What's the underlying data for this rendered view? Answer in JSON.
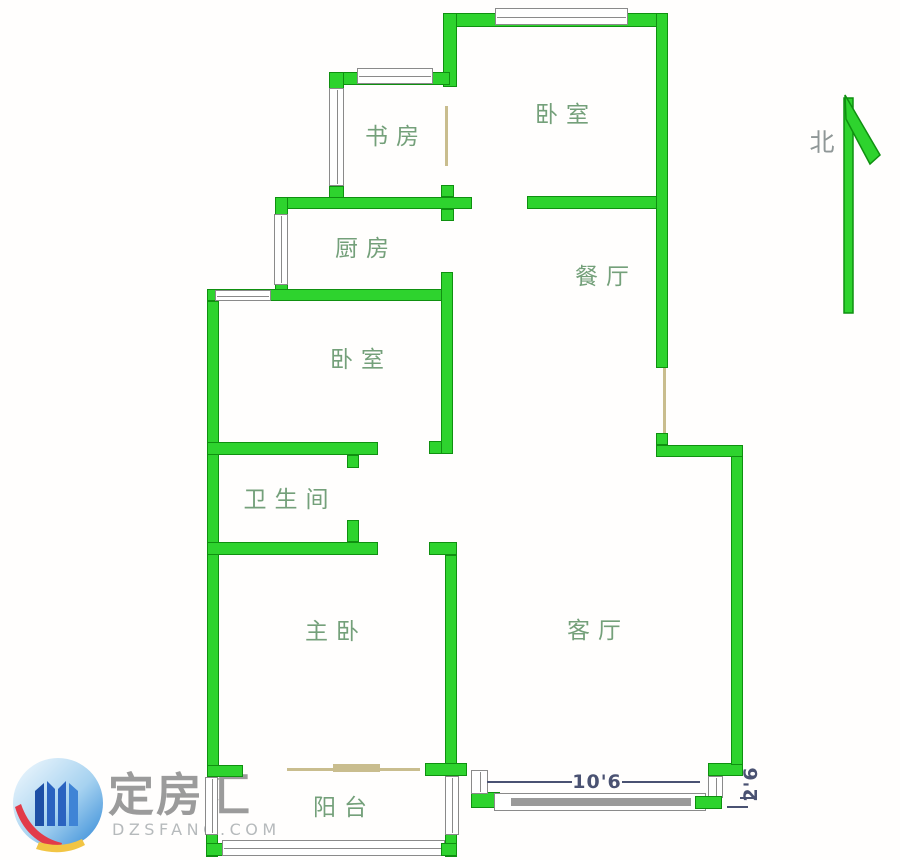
{
  "title": "apartment-floor-plan",
  "colors": {
    "wall_fill": "#2ed32e",
    "wall_border": "#0f9010",
    "window_border": "#8a8a8a",
    "window_fill": "#9a9a9a",
    "tan": "#c9bd8e",
    "label": "#74a07a",
    "north": "#8f9797",
    "dimension": "#4a5272",
    "watermark_title": "#9b9b9b",
    "watermark_domain": "#b6babc",
    "logo_blue_dark": "#1d4fa6",
    "logo_blue_mid": "#2a63c0",
    "logo_blue_light": "#3f84d6",
    "logo_red": "#e23b49",
    "logo_yellow": "#f2c544"
  },
  "rooms": [
    {
      "id": "study",
      "label": "书房"
    },
    {
      "id": "bedroom-top",
      "label": "卧室"
    },
    {
      "id": "kitchen",
      "label": "厨房"
    },
    {
      "id": "dining",
      "label": "餐厅"
    },
    {
      "id": "bedroom-mid",
      "label": "卧室"
    },
    {
      "id": "bathroom",
      "label": "卫生间"
    },
    {
      "id": "master",
      "label": "主卧"
    },
    {
      "id": "living",
      "label": "客厅"
    },
    {
      "id": "balcony",
      "label": "阳台"
    }
  ],
  "compass": {
    "label": "北"
  },
  "dimensions": [
    {
      "value": "10'6"
    },
    {
      "value": "2'6"
    }
  ],
  "watermark": {
    "title": "定房汇",
    "domain": "DZSFANG.COM"
  }
}
